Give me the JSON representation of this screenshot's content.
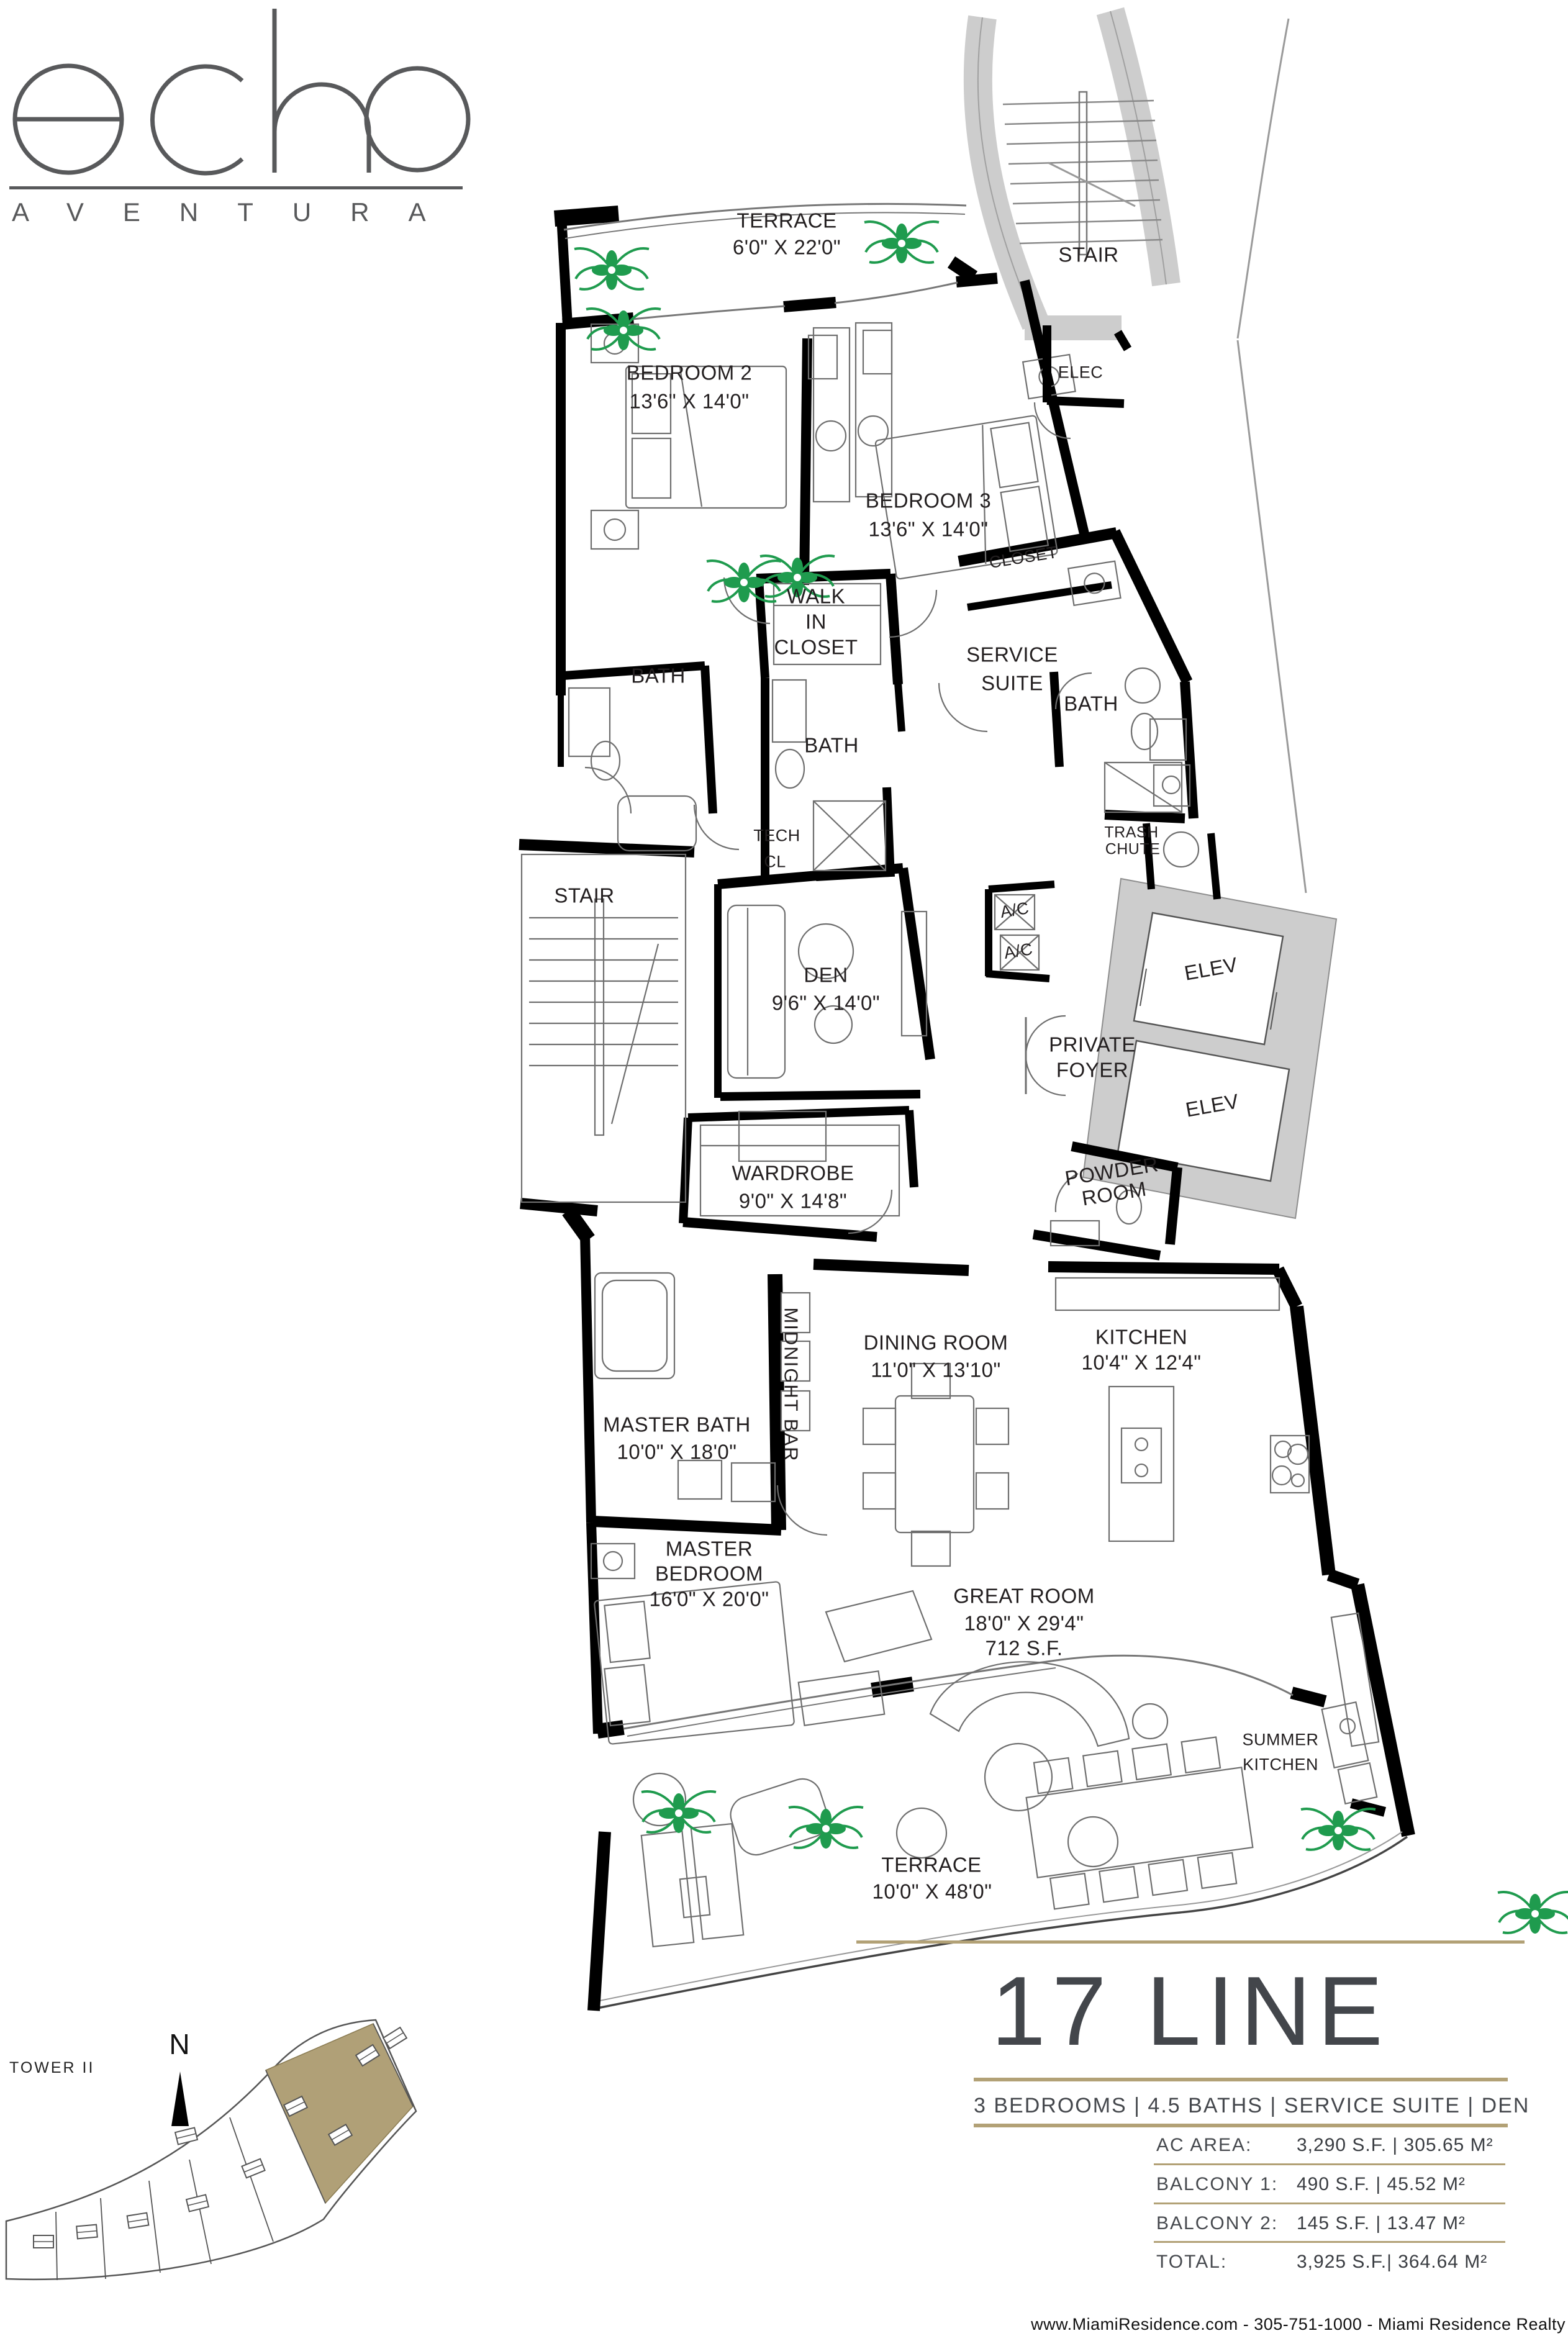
{
  "logo": {
    "brand": "echo",
    "sub": "AVENTURA"
  },
  "plan": {
    "rooms": {
      "terrace_top": {
        "line1": "TERRACE",
        "line2": "6'0\" X 22'0\""
      },
      "stair_top": {
        "line1": "STAIR"
      },
      "bedroom_2": {
        "line1": "BEDROOM 2",
        "line2": "13'6\" X 14'0\""
      },
      "elec": {
        "line1": "ELEC"
      },
      "bedroom_3": {
        "line1": "BEDROOM 3",
        "line2": "13'6\" X 14'0\""
      },
      "closet_service": {
        "line1": "CLOSET"
      },
      "walk_in_closet": {
        "line1": "WALK",
        "line2": "IN",
        "line3": "CLOSET"
      },
      "bath_2": {
        "line1": "BATH"
      },
      "service_suite": {
        "line1": "SERVICE",
        "line2": "SUITE"
      },
      "bath_3": {
        "line1": "BATH"
      },
      "tech_closet": {
        "line1": "TECH",
        "line2": "CL"
      },
      "bath_service": {
        "line1": "BATH"
      },
      "trash_chute": {
        "line1": "TRASH",
        "line2": "CHUTE"
      },
      "stair_unit": {
        "line1": "STAIR"
      },
      "den": {
        "line1": "DEN",
        "line2": "9'6\" X 14'0\""
      },
      "ac_1": {
        "line1": "A/C"
      },
      "ac_2": {
        "line1": "A/C"
      },
      "elev_1": {
        "line1": "ELEV"
      },
      "elev_2": {
        "line1": "ELEV"
      },
      "private_foyer": {
        "line1": "PRIVATE",
        "line2": "FOYER"
      },
      "wardrobe": {
        "line1": "WARDROBE",
        "line2": "9'0\" X 14'8\""
      },
      "powder_room": {
        "line1": "POWDER",
        "line2": "ROOM"
      },
      "midnight_bar": {
        "line1": "MIDNIGHT BAR"
      },
      "dining_room": {
        "line1": "DINING ROOM",
        "line2": "11'0\" X 13'10\""
      },
      "kitchen": {
        "line1": "KITCHEN",
        "line2": "10'4\" X 12'4\""
      },
      "master_bath": {
        "line1": "MASTER BATH",
        "line2": "10'0\" X 18'0\""
      },
      "master_bedroom": {
        "line1": "MASTER",
        "line2": "BEDROOM",
        "line3": "16'0\" X 20'0\""
      },
      "great_room": {
        "line1": "GREAT ROOM",
        "line2": "18'0\" X 29'4\"",
        "line3": "712 S.F."
      },
      "summer_kitchen": {
        "line1": "SUMMER",
        "line2": "KITCHEN"
      },
      "terrace_bottom": {
        "line1": "TERRACE",
        "line2": "10'0\" X 48'0\""
      }
    }
  },
  "unit": {
    "title": "17 LINE",
    "features": "3 BEDROOMS | 4.5 BATHS | SERVICE SUITE | DEN",
    "specs": [
      {
        "label": "AC AREA:",
        "value": "3,290 S.F. | 305.65 M²"
      },
      {
        "label": "BALCONY 1:",
        "value": "490 S.F. | 45.52 M²"
      },
      {
        "label": "BALCONY 2:",
        "value": "145 S.F. | 13.47 M²"
      },
      {
        "label": "TOTAL:",
        "value": "3,925 S.F.| 364.64 M²"
      }
    ]
  },
  "keyplan": {
    "tower": "TOWER II",
    "north": "N"
  },
  "footer": {
    "text": "www.MiamiResidence.com  -  305-751-1000  -  Miami Residence Realty"
  },
  "colors": {
    "accent_gold": "#b2a176",
    "keyplan_highlight": "#b0a077",
    "wall_black": "#000000",
    "core_gray": "#cdcdcd",
    "plant_green": "#1f9b4e",
    "heading_gray": "#43464b",
    "logo_gray": "#58595b"
  }
}
